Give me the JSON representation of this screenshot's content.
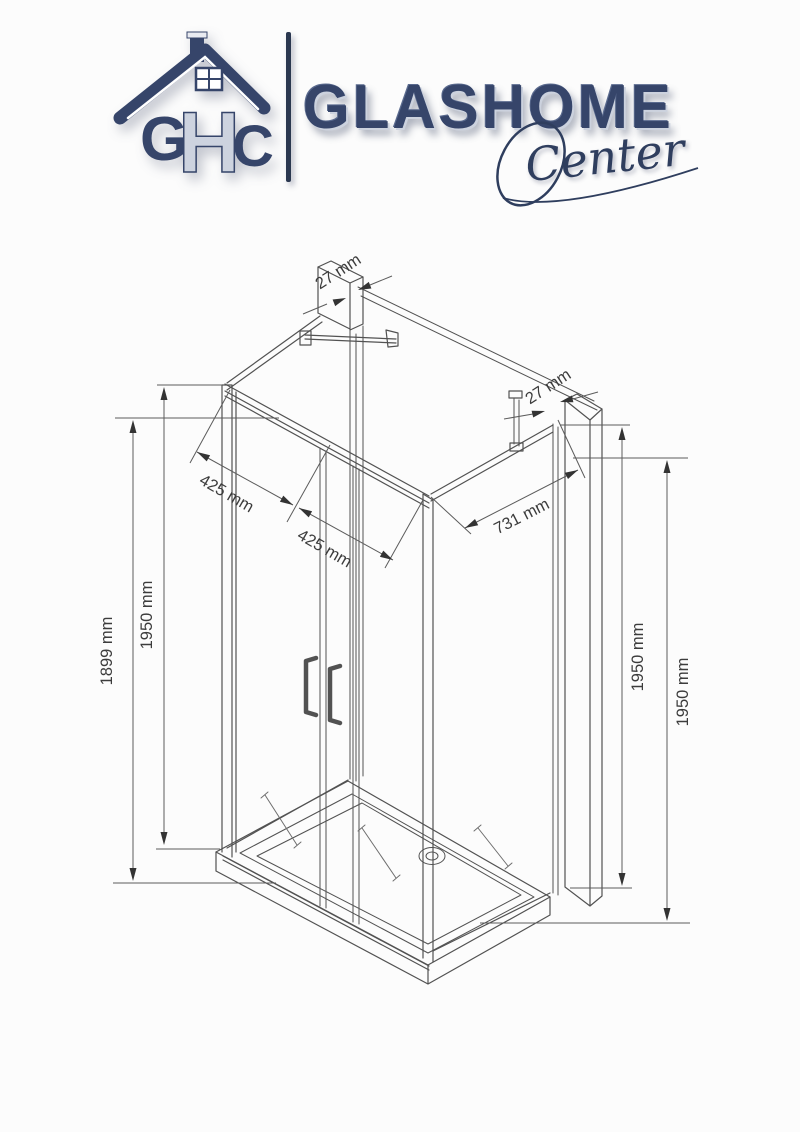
{
  "logo": {
    "monogram_letters": [
      "G",
      "H",
      "C"
    ],
    "brand": "GLASHOME",
    "script": "Center",
    "navy": "#36456a"
  },
  "drawing": {
    "dimensions": {
      "profile_top": "27 mm",
      "profile_right": "27 mm",
      "front_panel_a": "425 mm",
      "front_panel_b": "425 mm",
      "side_panel": "731 mm",
      "height_outer_left": "1899 mm",
      "height_left": "1950 mm",
      "height_right_inner": "1950 mm",
      "height_right_outer": "1950 mm"
    }
  }
}
